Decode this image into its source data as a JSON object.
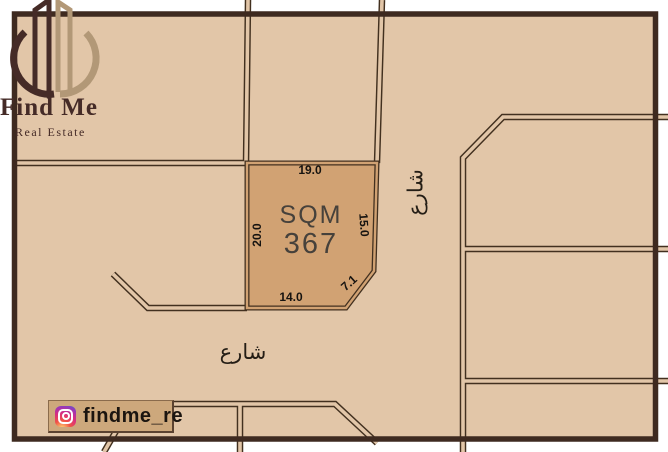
{
  "brand": {
    "name": "Find Me",
    "tagline": "Real Estate",
    "logo_icon": "buildings-circle-logo"
  },
  "plot": {
    "area_unit": "SQM",
    "area_value": "367",
    "dimensions": {
      "top": "19.0",
      "left": "20.0",
      "right": "15.0",
      "corner": "7.1",
      "bottom": "14.0"
    }
  },
  "streets": {
    "right_street_label": "شارع",
    "bottom_street_label": "شارع"
  },
  "social": {
    "handle": "findme_re",
    "icon": "instagram-icon"
  },
  "colors": {
    "background": "#e2c6a8",
    "plot_fill": "#d1a273",
    "frame": "#3e2a20",
    "street_line": "#42301f",
    "logo_dark": "#452b27",
    "logo_tan": "#b29877",
    "dimension_text": "#161310",
    "area_text": "#46413b",
    "badge_fill": "#cda87c"
  }
}
